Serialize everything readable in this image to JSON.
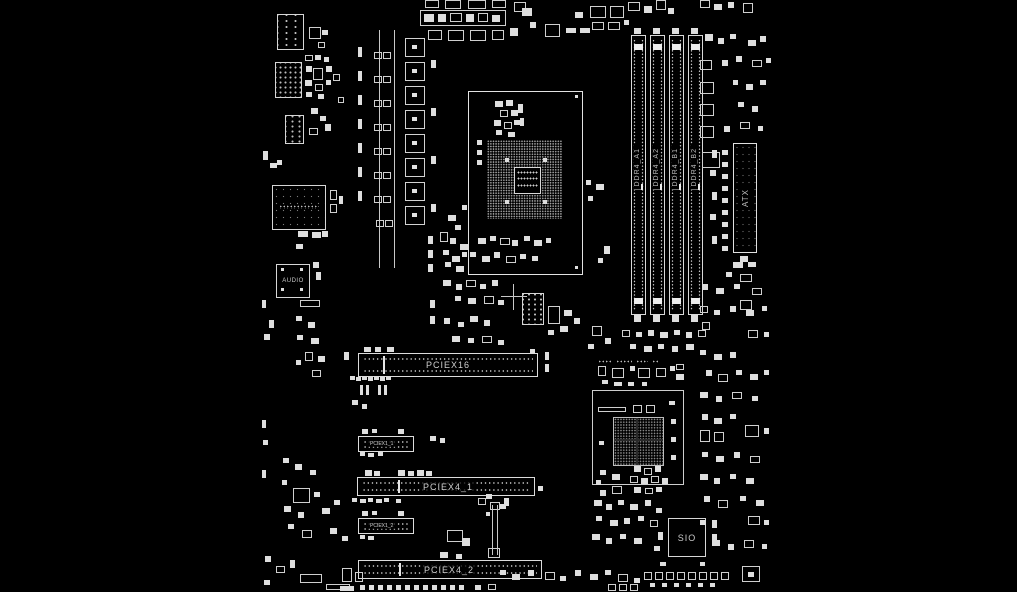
{
  "board": {
    "slots": {
      "pciex16": "PCIEX16",
      "pciex4_1": "PCIEX4_1",
      "pciex4_2": "PCIEX4_2",
      "pciex1_1": "PCIEX1_1",
      "pciex1_2": "PCIEX1_2"
    },
    "dimm_slots": [
      "DDR4_A1",
      "DDR4_A2",
      "DDR4_B1",
      "DDR4_B2"
    ],
    "power_connector_label": "ATX",
    "audio_chip_label": "AUDIO",
    "super_io_label": "SIO",
    "colors": {
      "background": "#000000",
      "line": "#d6d6d6",
      "label": "#c8c8c8"
    }
  }
}
